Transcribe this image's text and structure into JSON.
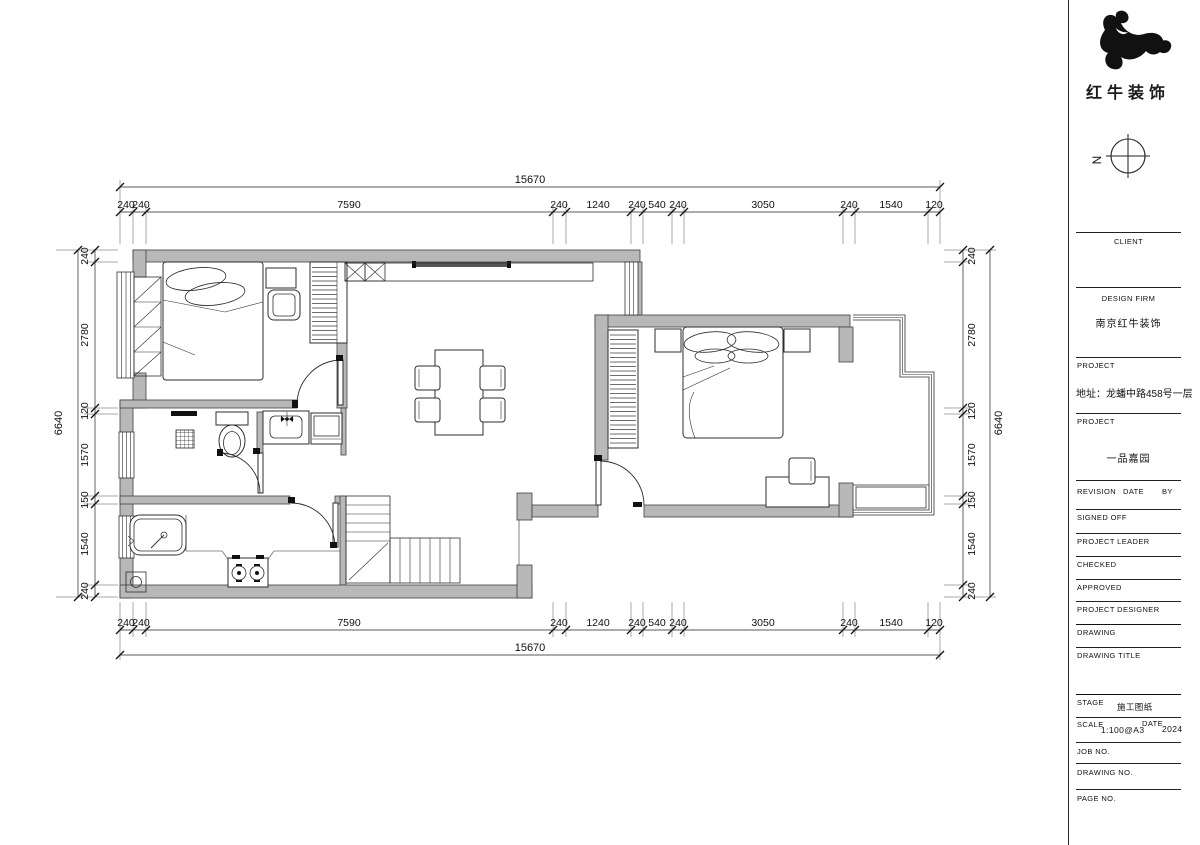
{
  "branding": {
    "company_name": "红牛装饰",
    "logo_icon": "bull-logo",
    "compass_letter": "N"
  },
  "title_block": {
    "client_label": "CLIENT",
    "design_firm_label": "DESIGN FIRM",
    "design_firm_value": "南京红牛装饰",
    "project_label": "PROJECT",
    "project_address": "地址：龙蟠中路458号一层",
    "project_label_2": "PROJECT",
    "project_name": "一品嘉园",
    "revision_label": "REVISION",
    "date_label": "DATE",
    "by_label": "BY",
    "signed_off_label": "SIGNED OFF",
    "project_leader_label": "PROJECT LEADER",
    "checked_label": "CHECKED",
    "approved_label": "APPROVED",
    "project_designer_label": "PROJECT DESIGNER",
    "drawing_label": "DRAWING",
    "drawing_title_label": "DRAWING TITLE",
    "stage_label": "STAGE",
    "stage_value": "施工图纸",
    "scale_label": "SCALE",
    "scale_value": "1:100@A3",
    "date_label_2": "DATE",
    "date_value": "2024",
    "job_no_label": "JOB NO.",
    "drawing_no_label": "DRAWING NO.",
    "page_no_label": "PAGE NO."
  },
  "dimensions": {
    "overall_width": "15670",
    "overall_height": "6640",
    "h_segments": [
      "240",
      "240",
      "7590",
      "240",
      "1240",
      "240",
      "540",
      "240",
      "3050",
      "240",
      "1540",
      "120"
    ],
    "v_segments": [
      "240",
      "2780",
      "120",
      "1570",
      "150",
      "1540",
      "240"
    ]
  }
}
